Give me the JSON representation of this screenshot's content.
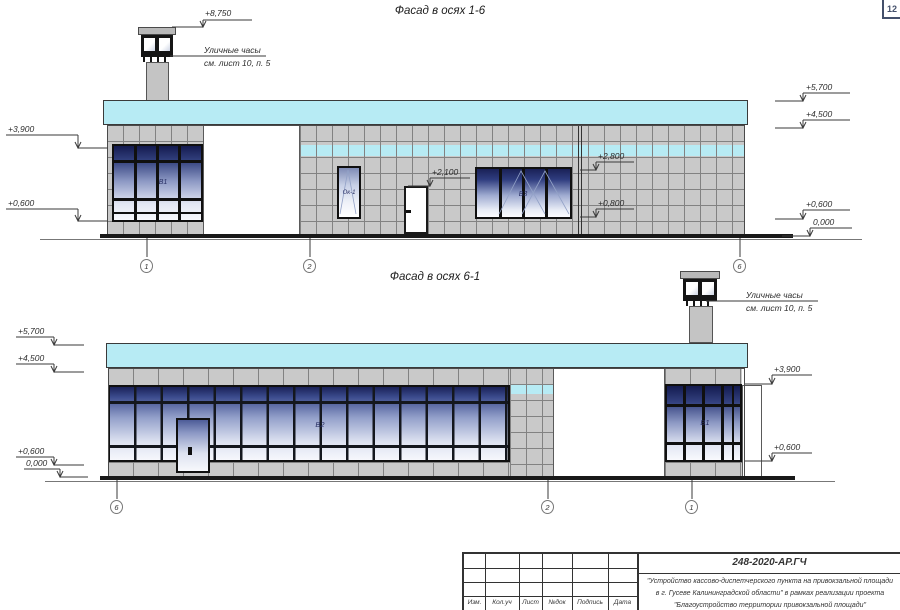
{
  "sheet": {
    "page_number": "12"
  },
  "colors": {
    "fascia_cyan": "#b7ebf4",
    "window_navy": "#1a2258",
    "tile_gray": "#c9c9c9"
  },
  "facade1": {
    "title": "Фасад в осях 1-6",
    "elevations": {
      "chimney_top": "+8,750",
      "left": [
        "+3,900",
        "+0,600"
      ],
      "right": [
        "+5,700",
        "+4,500",
        "+0,600",
        "0,000"
      ],
      "door_top": "+2,100",
      "window_top": "+2,800",
      "window_sill": "+0,800"
    },
    "clock_note": {
      "line1": "Уличные часы",
      "line2": "см. лист 10, п. 5"
    },
    "labels": {
      "window_b1": "В1",
      "window_ok1": "Ок-1",
      "window_b3": "В3"
    },
    "axes": [
      "1",
      "2",
      "6"
    ]
  },
  "facade2": {
    "title": "Фасад в осях 6-1",
    "elevations": {
      "left": [
        "+5,700",
        "+4,500",
        "+0,600",
        "0,000"
      ],
      "right": [
        "+3,900",
        "+0,600"
      ]
    },
    "clock_note": {
      "line1": "Уличные часы",
      "line2": "см. лист 10, п. 5"
    },
    "labels": {
      "window_b2": "В2",
      "window_b1": "В1"
    },
    "axes": [
      "6",
      "2",
      "1"
    ]
  },
  "titleblock": {
    "doc_number": "248-2020-АР.ГЧ",
    "description": [
      "\"Устройство кассово-диспетчерского пункта на привокзальной площади",
      "в г. Гусеве Калининградской области\" в рамках реализации проекта",
      "\"Благоустройство территории привокзальной площади\""
    ],
    "columns": [
      "Изм.",
      "Кол.уч",
      "Лист",
      "№док",
      "Подпись",
      "Дата"
    ]
  }
}
